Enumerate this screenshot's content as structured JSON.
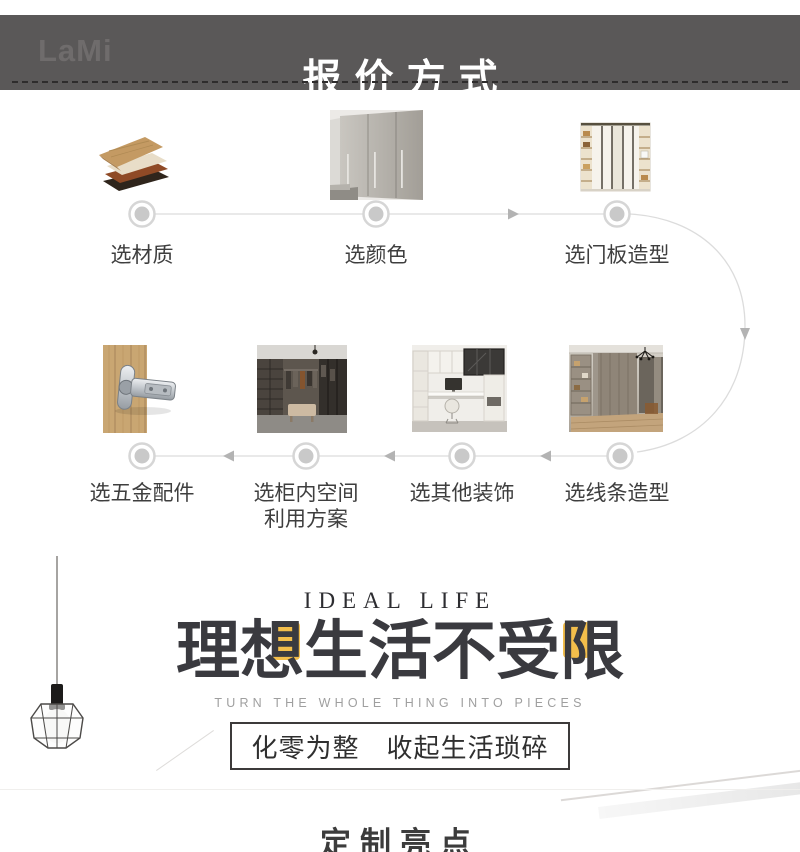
{
  "colors": {
    "header_bg": "#5A5858",
    "accent_yellow": "#F3BE4B",
    "connector_gray": "#D9D9D9",
    "text_dark": "#3F3F3F"
  },
  "header": {
    "logo_text": "LaMi",
    "title": "报价方式"
  },
  "flow": {
    "row1": [
      {
        "label": "选材质",
        "photo": "material-samples-photo"
      },
      {
        "label": "选颜色",
        "photo": "gray-wardrobe-photo"
      },
      {
        "label": "选门板造型",
        "photo": "door-panel-wardrobe-photo"
      }
    ],
    "row2": [
      {
        "label": "选五金配件",
        "photo": "hinge-hardware-photo"
      },
      {
        "label_line1": "选柜内空间",
        "label_line2": "利用方案",
        "photo": "walk-in-closet-photo"
      },
      {
        "label": "选其他装饰",
        "photo": "study-desk-photo"
      },
      {
        "label": "选线条造型",
        "photo": "molding-wardrobe-photo"
      }
    ]
  },
  "hero": {
    "eyebrow": "IDEAL LIFE",
    "title_chars": [
      "理",
      "想",
      "生",
      "活",
      "不",
      "受",
      "限"
    ],
    "subtitle": "TURN THE WHOLE THING INTO PIECES",
    "slogan": "化零为整　收起生活琐碎"
  },
  "footer": {
    "title": "定制亮点"
  }
}
